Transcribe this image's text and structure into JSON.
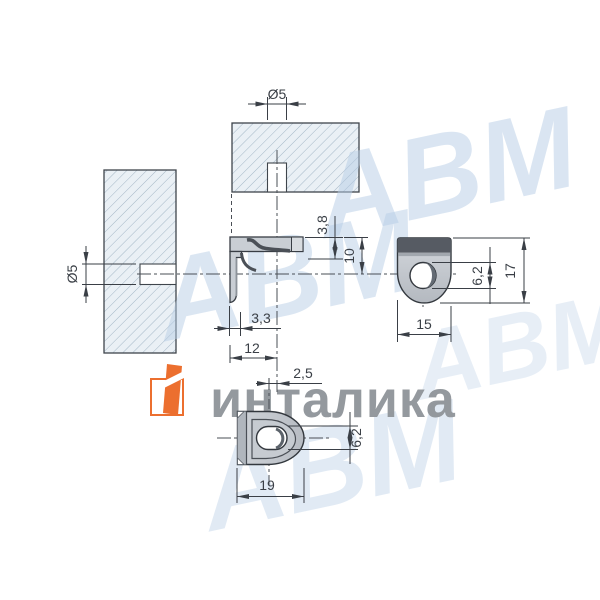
{
  "drawing": {
    "type": "technical-drawing-orthographic-views",
    "dimensions": {
      "top_section_hole_diameter": "Ø5",
      "left_section_hole_diameter": "Ø5",
      "side_hook_depth": "3,8",
      "side_top_to_center": "10",
      "side_flange_thickness": "3,3",
      "side_edge_to_center": "12",
      "side_hole_offset": "2,5",
      "front_hole_diameter": "6,2",
      "front_height": "17",
      "front_width": "15",
      "bottom_hole_width": "6,2",
      "bottom_width": "19"
    }
  },
  "branding": {
    "logo_text": "инталика",
    "watermark_text": "АВМ"
  },
  "colors": {
    "accent_orange": "#ec6f2f",
    "watermark_blue": "#b6cde6",
    "brand_gray": "#8f9499",
    "line_dark": "#3a3f46",
    "hatch_fill": "#eaf0f5",
    "hatch_line": "#a4b7c6",
    "part_gray": "#c9ced4",
    "part_dark": "#565b63"
  }
}
